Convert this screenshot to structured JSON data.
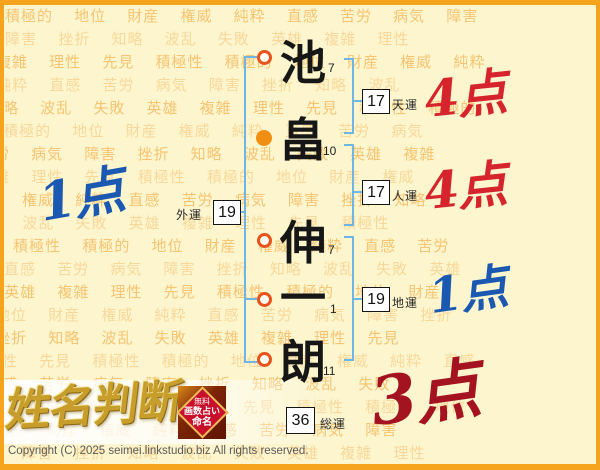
{
  "chart": {
    "characters": [
      {
        "char": "池",
        "strokes": "7",
        "marker": "hollow"
      },
      {
        "char": "畠",
        "strokes": "10",
        "marker": "filled"
      },
      {
        "char": "伸",
        "strokes": "7",
        "marker": "hollow"
      },
      {
        "char": "一",
        "strokes": "1",
        "marker": "hollow"
      },
      {
        "char": "朗",
        "strokes": "11",
        "marker": "hollow"
      }
    ],
    "fortunes": {
      "tenun": {
        "label": "天運",
        "value": "17"
      },
      "jinun": {
        "label": "人運",
        "value": "17"
      },
      "chiun": {
        "label": "地運",
        "value": "19"
      },
      "gaiun": {
        "label": "外運",
        "value": "19"
      },
      "souun": {
        "label": "総運",
        "value": "36"
      }
    },
    "scores": {
      "tenun": {
        "text": "4点",
        "color": "#D5242C"
      },
      "jinun": {
        "text": "4点",
        "color": "#D5242C"
      },
      "chiun": {
        "text": "1点",
        "color": "#1A58B2"
      },
      "gaiun": {
        "text": "1点",
        "color": "#1A58B2"
      },
      "souun": {
        "text": "3点",
        "color": "#A41320"
      }
    }
  },
  "logo": {
    "text": "姓名判断"
  },
  "badge": {
    "line1": "無料",
    "line2": "画数占い",
    "line3": "命名"
  },
  "footer": {
    "copyright": "Copyright (C) 2025 seimei.linkstudio.biz All rights reserved."
  },
  "background": {
    "words": [
      "積極的",
      "地位",
      "財産",
      "権威",
      "純粋",
      "直感",
      "苦労",
      "病気",
      "障害",
      "挫折",
      "知略",
      "波乱",
      "失敗",
      "英雄",
      "複雑",
      "理性",
      "先見",
      "積極性"
    ],
    "row_colors": [
      "#F5BC63",
      "#F8D492"
    ]
  },
  "colors": {
    "frame_border": "#F6A41E",
    "page_bg": "#FCF5CD",
    "bracket_blue": "#6FB5E5",
    "marker_ring": "#E8521D",
    "marker_filled": "#F18F15"
  }
}
